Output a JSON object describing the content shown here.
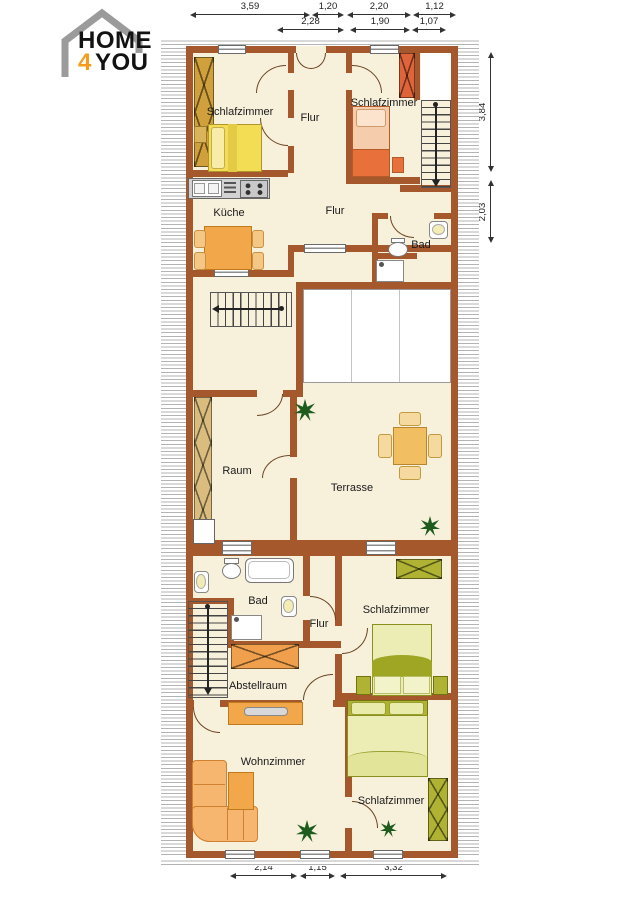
{
  "logo": {
    "home": "HOME",
    "four": "4",
    "you": "YOU"
  },
  "rooms": {
    "bedroom_top_left": "Schlafzimmer",
    "hall_top": "Flur",
    "bedroom_top_right": "Schlafzimmer",
    "kitchen": "Küche",
    "hall_middle": "Flur",
    "bath_top": "Bad",
    "room_left": "Raum",
    "terrace": "Terrasse",
    "bath_lower": "Bad",
    "hall_lower": "Flur",
    "bedroom_mid_right": "Schlafzimmer",
    "storage": "Abstellraum",
    "living_room": "Wohnzimmer",
    "bedroom_bottom_right": "Schlafzimmer"
  },
  "dimensions": {
    "top_row1": [
      "3,59",
      "1,20",
      "2,20",
      "1,12"
    ],
    "top_row2": [
      "2,28",
      "1,90",
      "1,07"
    ],
    "right": [
      "3,84",
      "2,03"
    ],
    "bottom": [
      "2,14",
      "1,15",
      "3,32"
    ]
  },
  "icons": {
    "plant": "star-shaped plant"
  },
  "colors": {
    "wall": "#A4582B",
    "floor": "#F7F0DB",
    "logo_accent": "#F59C1A",
    "hatch_gray": "#B3B3B3",
    "furniture_gold": "#CFA03C",
    "furniture_yellow": "#F2DD55",
    "furniture_orange": "#F2A84A",
    "furniture_red_orange": "#E8703A",
    "furniture_salmon": "#F6CDAC",
    "furniture_olive": "#AFB233",
    "furniture_pale_olive": "#ECEDB4",
    "furniture_tan": "#D9BC7E",
    "plant_green": "#1D5C1D"
  }
}
